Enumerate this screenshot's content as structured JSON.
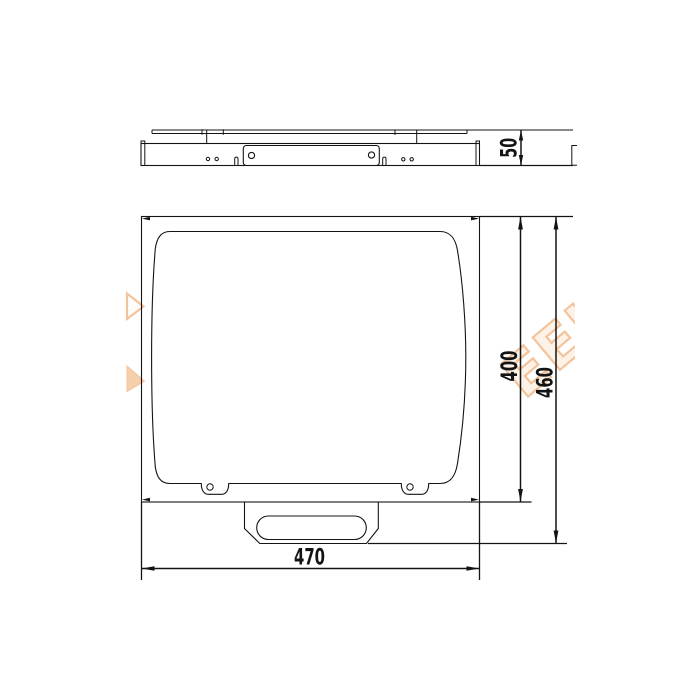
{
  "drawing": {
    "background": "#ffffff",
    "line_color": "#141414",
    "dimensions": {
      "depth": "50",
      "panel_height": "400",
      "overall_height": "460",
      "width": "470"
    }
  },
  "watermark": {
    "text_fragment": "EEI",
    "outline_color": "#f2bd92",
    "fill_color": "#fdf1e5"
  }
}
